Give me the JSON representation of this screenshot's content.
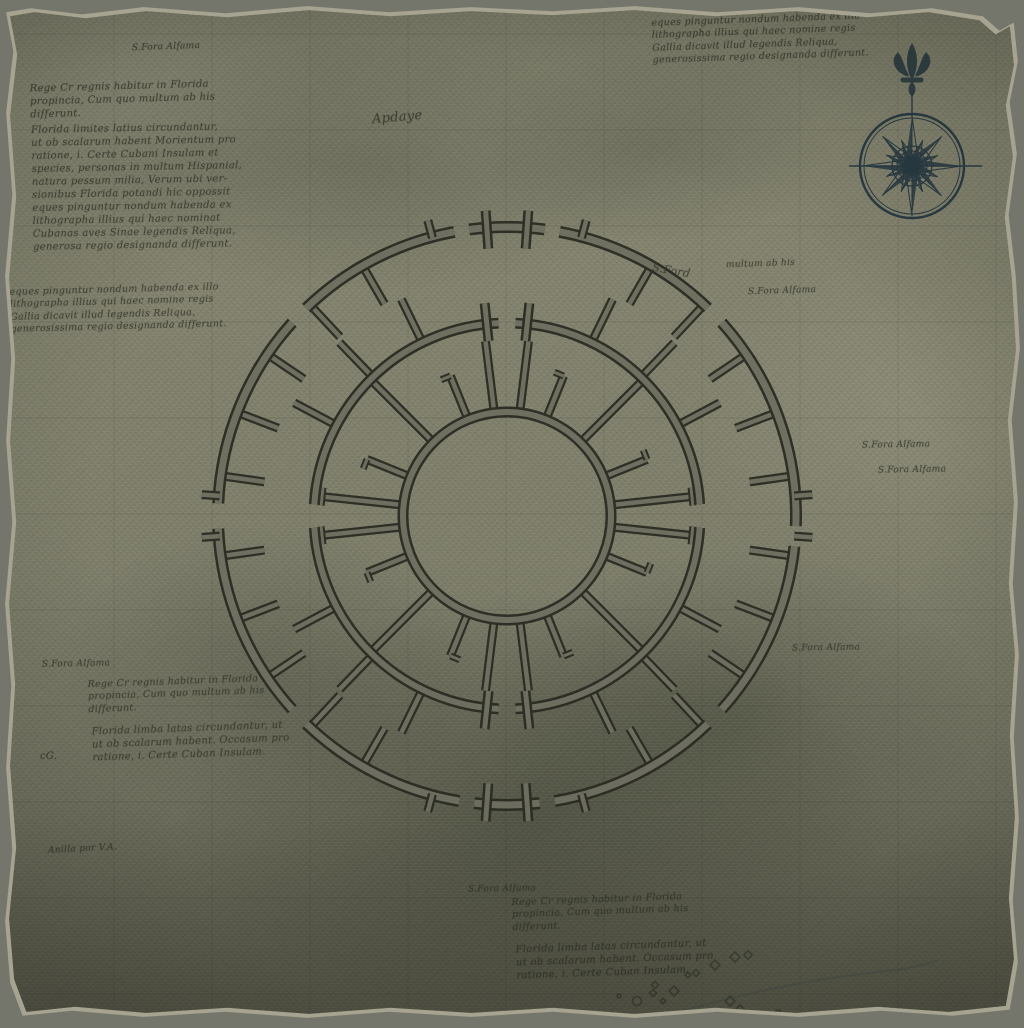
{
  "palette": {
    "backdrop": "#75766b",
    "parchment": "#8a8a75",
    "ink": "#32342a",
    "compass_ink": "#1f3340",
    "wall_fill": "#6e6f60",
    "wall_line": "#2a2b22",
    "grid": "rgba(28,30,22,0.10)",
    "river": "rgba(55,75,88,0.35)"
  },
  "paragraphs": {
    "A": [
      "Rege Cr regnis habitur in Florida",
      "propincia, Cum quo multum ab his",
      "differunt."
    ],
    "B": [
      "Florida limites latius circundantur,",
      "ut ob scalarum habent Morientum pro",
      "ratione, i. Certe Cubani Insulam et",
      "species, personas in multum Hispanial,",
      "natura pessum milia, Verum ubi ver-",
      "sionibus Florida potandi hic oppossit",
      "eques pinguntur nondum habenda ex",
      "lithographa illius qui haec nominat",
      "Cubanas aves Sinae legendis Reliqua,",
      "generosa regio designanda differunt."
    ],
    "C": [
      "eques pinguntur nondum habenda ex illo",
      "lithographa illius qui haec nomine regis",
      "Gallia dicavit illud legendis Reliqua,",
      "generosissima regio designanda differunt."
    ],
    "D": [
      "Florida limba latas circundantur, ut",
      "ut ob scalarum habent. Occasum pro",
      "ratione, i. Certe Cuban Insulam."
    ]
  },
  "text_blocks": [
    {
      "name": "block-top-right",
      "para": "C",
      "x": 648,
      "y": 10,
      "size": 9.5,
      "rot": -2
    },
    {
      "name": "block-top-left-1",
      "para": "A",
      "x": 26,
      "y": 76,
      "size": 10,
      "rot": -1.5
    },
    {
      "name": "block-top-left-2",
      "para": "B",
      "x": 28,
      "y": 118,
      "size": 10,
      "rot": -1
    },
    {
      "name": "block-left-mid",
      "para": "C",
      "x": 6,
      "y": 280,
      "size": 9.5,
      "rot": -1.5
    },
    {
      "name": "block-midleft-low-1",
      "para": "A",
      "x": 84,
      "y": 672,
      "size": 9.5,
      "rot": -2
    },
    {
      "name": "block-midleft-low-2",
      "para": "D",
      "x": 88,
      "y": 718,
      "size": 10,
      "rot": -2
    },
    {
      "name": "block-bottom-1",
      "para": "A",
      "x": 508,
      "y": 890,
      "size": 9.5,
      "rot": -2
    },
    {
      "name": "block-bottom-2",
      "para": "D",
      "x": 512,
      "y": 936,
      "size": 10,
      "rot": -2
    }
  ],
  "labels": [
    {
      "text": "S.Fora Alfama",
      "x": 128,
      "y": 38,
      "size": 9,
      "rot": -2
    },
    {
      "text": "Apdaye",
      "x": 368,
      "y": 106,
      "size": 13,
      "rot": -5
    },
    {
      "text": "multum ab his",
      "x": 722,
      "y": 255,
      "size": 9,
      "rot": -2
    },
    {
      "text": "S.Fora Alfama",
      "x": 744,
      "y": 282,
      "size": 9,
      "rot": -2
    },
    {
      "text": "S.Ford",
      "x": 648,
      "y": 260,
      "size": 11,
      "rot": 10
    },
    {
      "text": "S.Fora Alfama",
      "x": 858,
      "y": 436,
      "size": 9,
      "rot": -1
    },
    {
      "text": "S.Fora Alfama",
      "x": 874,
      "y": 461,
      "size": 9,
      "rot": -1
    },
    {
      "text": "S.Fora Alfama",
      "x": 788,
      "y": 639,
      "size": 9,
      "rot": -1
    },
    {
      "text": "S.Fora Alfama",
      "x": 38,
      "y": 655,
      "size": 9,
      "rot": -1
    },
    {
      "text": "S.Fora Alfama",
      "x": 464,
      "y": 880,
      "size": 9,
      "rot": -1
    },
    {
      "text": "Anilla por V.A.",
      "x": 44,
      "y": 840,
      "size": 9,
      "rot": -3
    },
    {
      "text": "cG.",
      "x": 36,
      "y": 746,
      "size": 10,
      "rot": 0
    }
  ],
  "compass": {
    "cx": 908,
    "cy": 162,
    "r_outer": 52,
    "r_inner": 48,
    "r_mid": 20,
    "r_hub": 15,
    "ew_line": {
      "x1": 845,
      "x2": 978
    },
    "stem": {
      "y1": 88,
      "y2": 112
    },
    "monogram": "D",
    "ornament": "fleur-de-lis",
    "ray_lengths": {
      "cardinal": 50,
      "intercardinal": 42,
      "minor": 28
    }
  },
  "structure": {
    "cx": 503,
    "cy": 512,
    "rings": [
      {
        "name": "outer",
        "r": 289,
        "band": 8,
        "gaps": [
          {
            "a": 44,
            "w": 4
          },
          {
            "a": 81,
            "w": 3
          },
          {
            "a": 99,
            "w": 3
          },
          {
            "a": 136,
            "w": 4
          },
          {
            "a": 180,
            "w": 5
          },
          {
            "a": 224,
            "w": 4
          },
          {
            "a": 262,
            "w": 3
          },
          {
            "a": 278,
            "w": 3
          },
          {
            "a": 316,
            "w": 4
          },
          {
            "a": 356,
            "w": 4
          }
        ]
      },
      {
        "name": "middle",
        "r": 193,
        "band": 7,
        "gaps": [
          {
            "a": 0,
            "w": 7
          },
          {
            "a": 90,
            "w": 5
          },
          {
            "a": 180,
            "w": 7
          },
          {
            "a": 270,
            "w": 5
          }
        ]
      },
      {
        "name": "inner",
        "r": 104,
        "band": 7,
        "gaps": []
      }
    ],
    "spokes": [
      {
        "group": "outer-inward",
        "r0": 285,
        "r1": 245,
        "tip": "none",
        "angles": [
          8,
          21,
          34,
          47,
          60,
          120,
          133,
          146,
          159,
          172,
          188,
          201,
          214,
          227,
          240,
          300,
          313,
          326,
          339,
          352
        ]
      },
      {
        "group": "middle-outward",
        "r0": 196,
        "r1": 241,
        "tip": "none",
        "angles": [
          28,
          46,
          64,
          116,
          134,
          152,
          208,
          226,
          244,
          296,
          314,
          332
        ]
      },
      {
        "group": "inner-short",
        "r0": 103,
        "r1": 151,
        "tip": "flag",
        "angles": [
          22,
          68,
          112,
          158,
          202,
          248,
          292,
          338
        ]
      },
      {
        "group": "inner-diagonal",
        "r0": 103,
        "r1": 190,
        "tip": "none",
        "angles": [
          45,
          135,
          225,
          315
        ]
      },
      {
        "group": "inner-vertical-pair",
        "r0": 103,
        "r1": 176,
        "tip": "none",
        "angles": [
          83,
          97,
          263,
          277
        ]
      },
      {
        "group": "corridor-horizontal",
        "r0": 103,
        "r1": 186,
        "tip": "cap",
        "angles": [
          174,
          186,
          354,
          6
        ]
      }
    ],
    "gates": [
      {
        "ring": "outer",
        "r0": 268,
        "r1": 306,
        "angles": [
          86,
          94,
          266,
          274
        ]
      },
      {
        "ring": "middle",
        "r0": 176,
        "r1": 214,
        "angles": [
          84,
          96,
          264,
          276
        ]
      }
    ],
    "tabs": [
      {
        "r0": 288,
        "r1": 306,
        "angles": [
          4,
          75,
          105,
          176,
          184,
          255,
          285,
          356
        ]
      }
    ]
  },
  "grid": {
    "xs": [
      110,
      208,
      306,
      404,
      502,
      600,
      698,
      796,
      894,
      992
    ],
    "ys": [
      30,
      126,
      222,
      318,
      414,
      510,
      606,
      702,
      798,
      894,
      990
    ]
  },
  "marks": [
    {
      "type": "diamond",
      "x": 731,
      "y": 953,
      "s": 7
    },
    {
      "type": "diamond",
      "x": 744,
      "y": 951,
      "s": 6
    },
    {
      "type": "diamond",
      "x": 711,
      "y": 961,
      "s": 7
    },
    {
      "type": "diamond",
      "x": 692,
      "y": 969,
      "s": 5
    },
    {
      "type": "diamond",
      "x": 684,
      "y": 971,
      "s": 4
    },
    {
      "type": "diamond",
      "x": 651,
      "y": 981,
      "s": 5
    },
    {
      "type": "diamond",
      "x": 649,
      "y": 989,
      "s": 5
    },
    {
      "type": "diamond",
      "x": 670,
      "y": 987,
      "s": 7
    },
    {
      "type": "circle",
      "x": 633,
      "y": 997,
      "s": 9
    },
    {
      "type": "diamond",
      "x": 726,
      "y": 997,
      "s": 7
    },
    {
      "type": "diamond",
      "x": 736,
      "y": 1006,
      "s": 7
    },
    {
      "type": "circle",
      "x": 774,
      "y": 1009,
      "s": 6
    },
    {
      "type": "circle",
      "x": 615,
      "y": 992,
      "s": 4
    },
    {
      "type": "diamond",
      "x": 659,
      "y": 997,
      "s": 4
    }
  ],
  "river": {
    "d": "M 655,1014 C 700,1000 760,985 820,975 C 870,967 902,968 934,956"
  }
}
